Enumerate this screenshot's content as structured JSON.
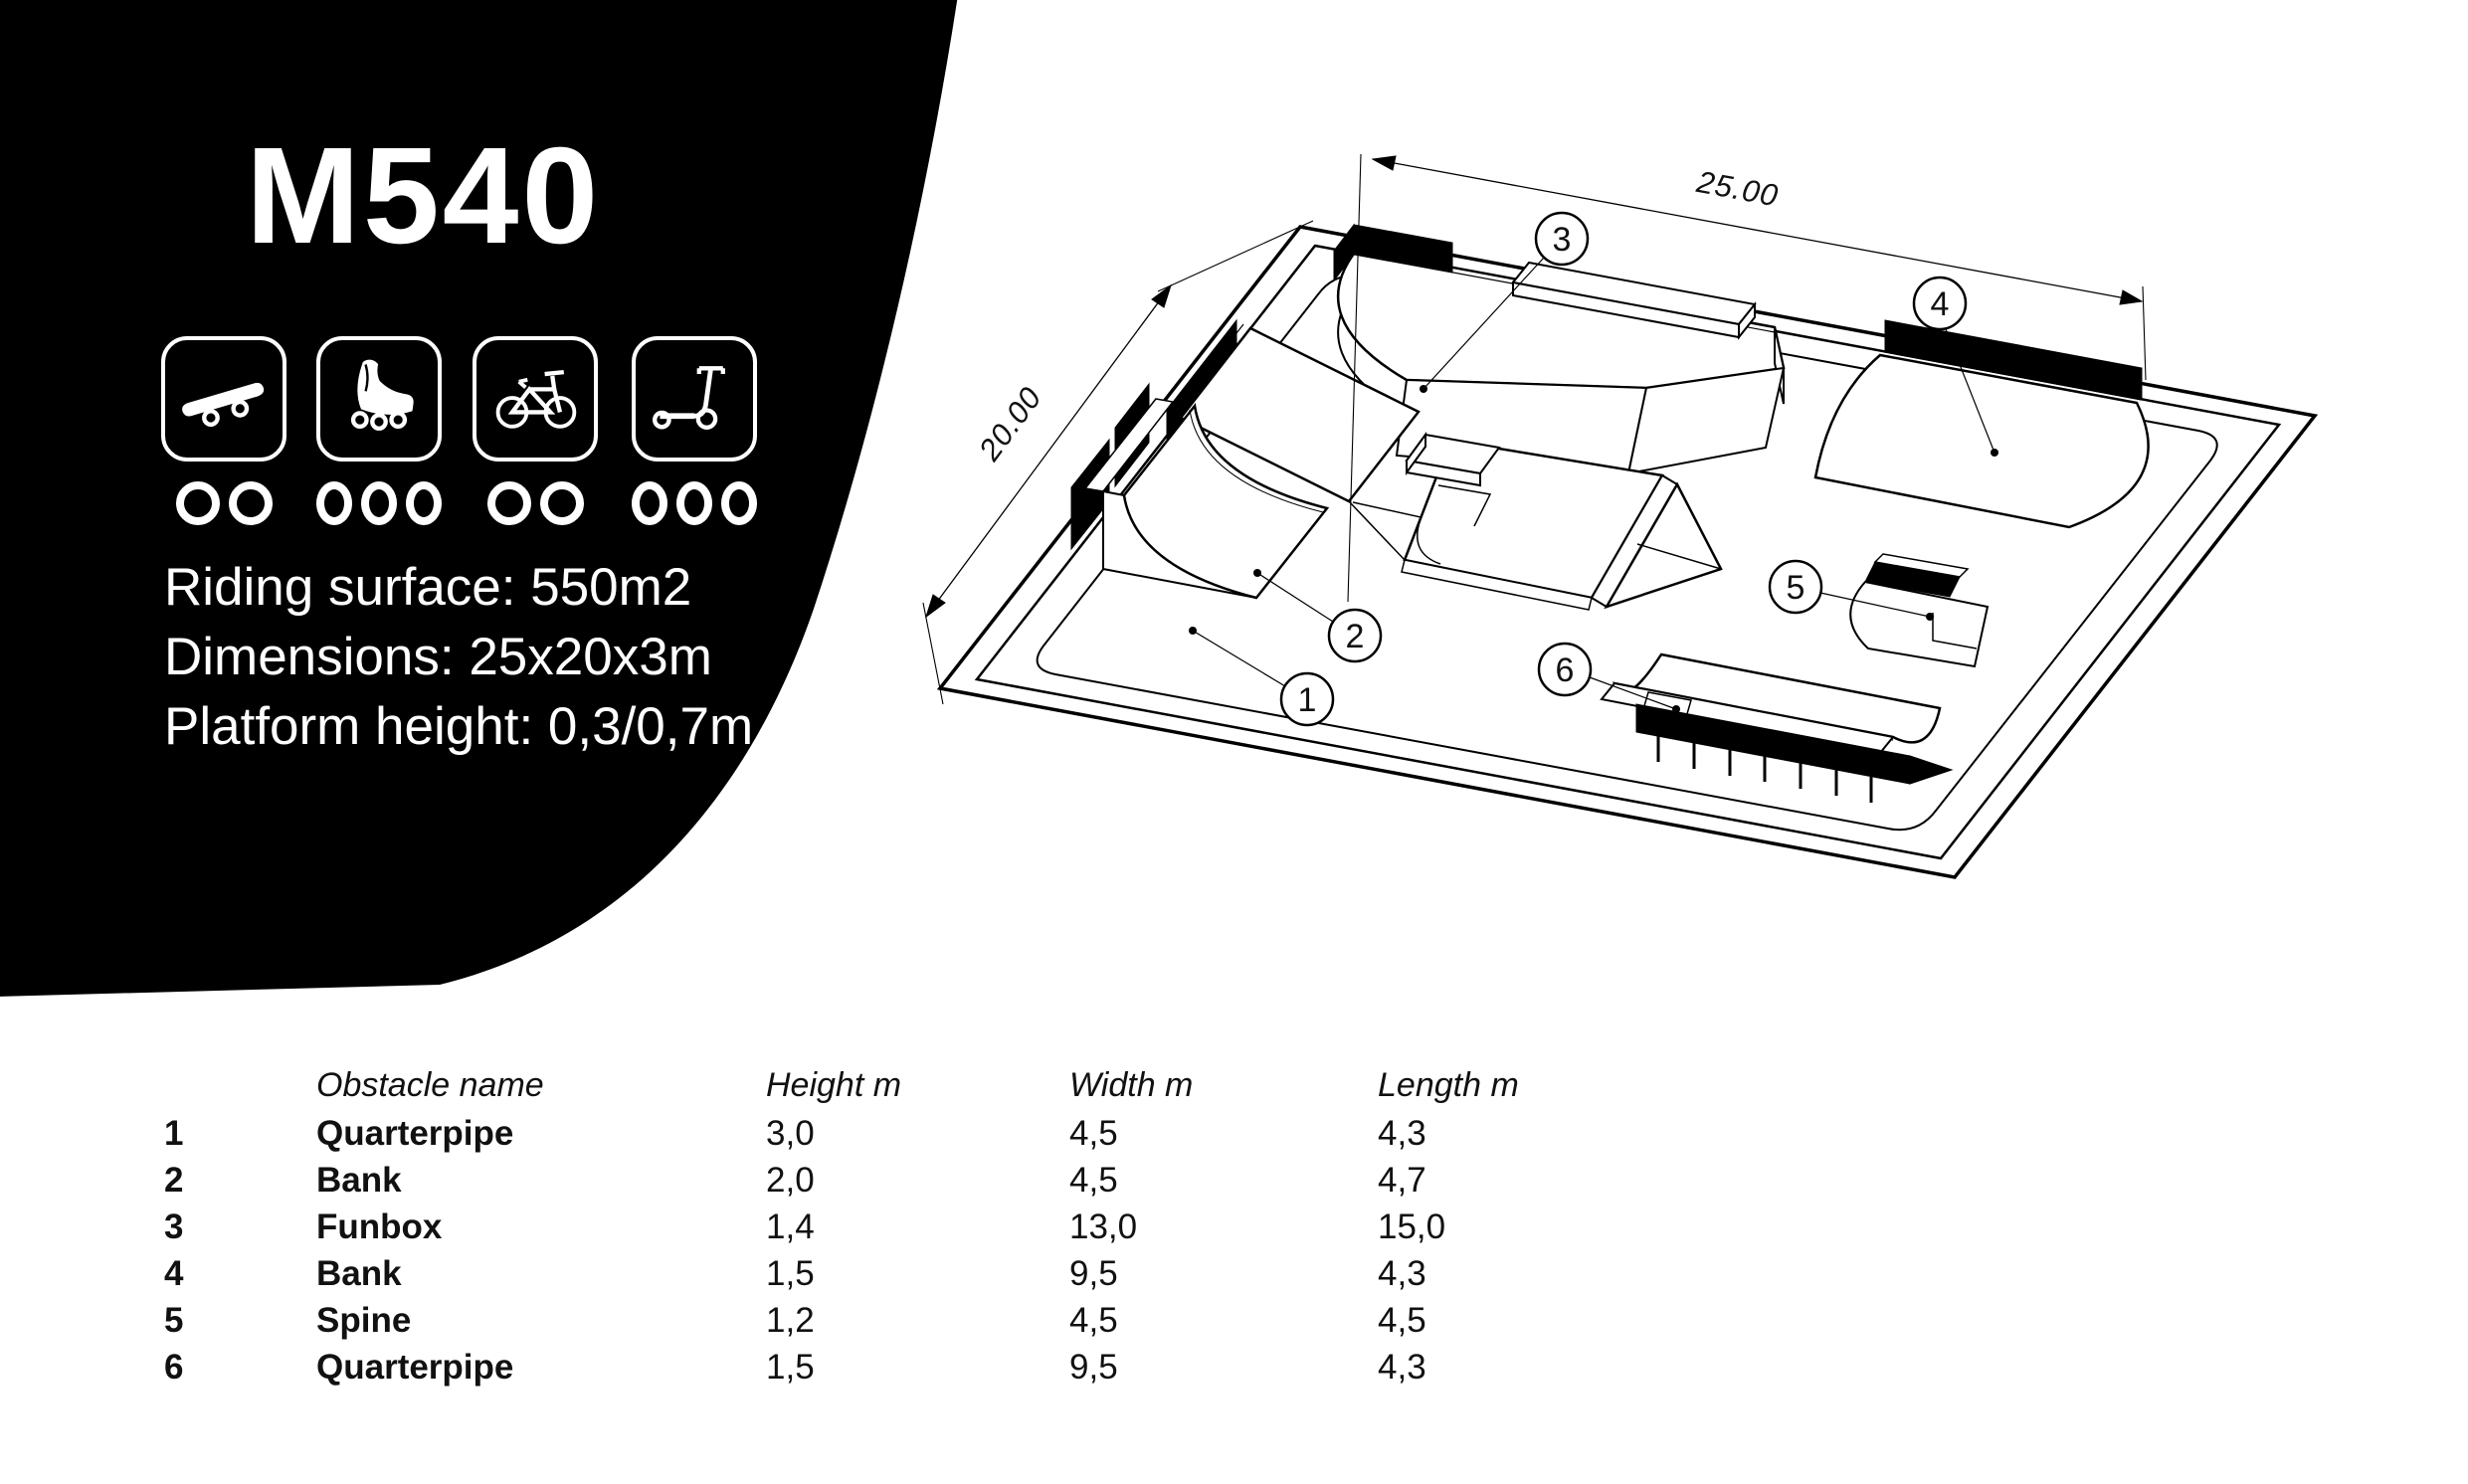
{
  "colors": {
    "background": "#ffffff",
    "panel": "#000000",
    "ink": "#000000",
    "text_on_dark": "#ffffff"
  },
  "hero": {
    "model": "M540",
    "icons": [
      {
        "name": "skateboard",
        "dots": 2
      },
      {
        "name": "inline-skates",
        "dots": 3
      },
      {
        "name": "bmx-bike",
        "dots": 2
      },
      {
        "name": "scooter",
        "dots": 3
      }
    ],
    "specs": {
      "riding_surface": "Riding surface: 550m2",
      "dimensions": "Dimensions: 25x20x3m",
      "platform_height": "Platform height: 0,3/0,7m"
    }
  },
  "drawing": {
    "width_dim": "25.00",
    "depth_dim": "20.00",
    "callouts": [
      "1",
      "2",
      "3",
      "4",
      "5",
      "6"
    ]
  },
  "table": {
    "headers": {
      "name": "Obstacle name",
      "height": "Height m",
      "width": "Width m",
      "length": "Length m"
    },
    "rows": [
      {
        "num": "1",
        "name": "Quarterpipe",
        "height": "3,0",
        "width": "4,5",
        "length": "4,3"
      },
      {
        "num": "2",
        "name": "Bank",
        "height": "2,0",
        "width": "4,5",
        "length": "4,7"
      },
      {
        "num": "3",
        "name": "Funbox",
        "height": "1,4",
        "width": "13,0",
        "length": "15,0"
      },
      {
        "num": "4",
        "name": "Bank",
        "height": "1,5",
        "width": "9,5",
        "length": "4,3"
      },
      {
        "num": "5",
        "name": "Spine",
        "height": "1,2",
        "width": "4,5",
        "length": "4,5"
      },
      {
        "num": "6",
        "name": "Quarterpipe",
        "height": "1,5",
        "width": "9,5",
        "length": "4,3"
      }
    ]
  }
}
